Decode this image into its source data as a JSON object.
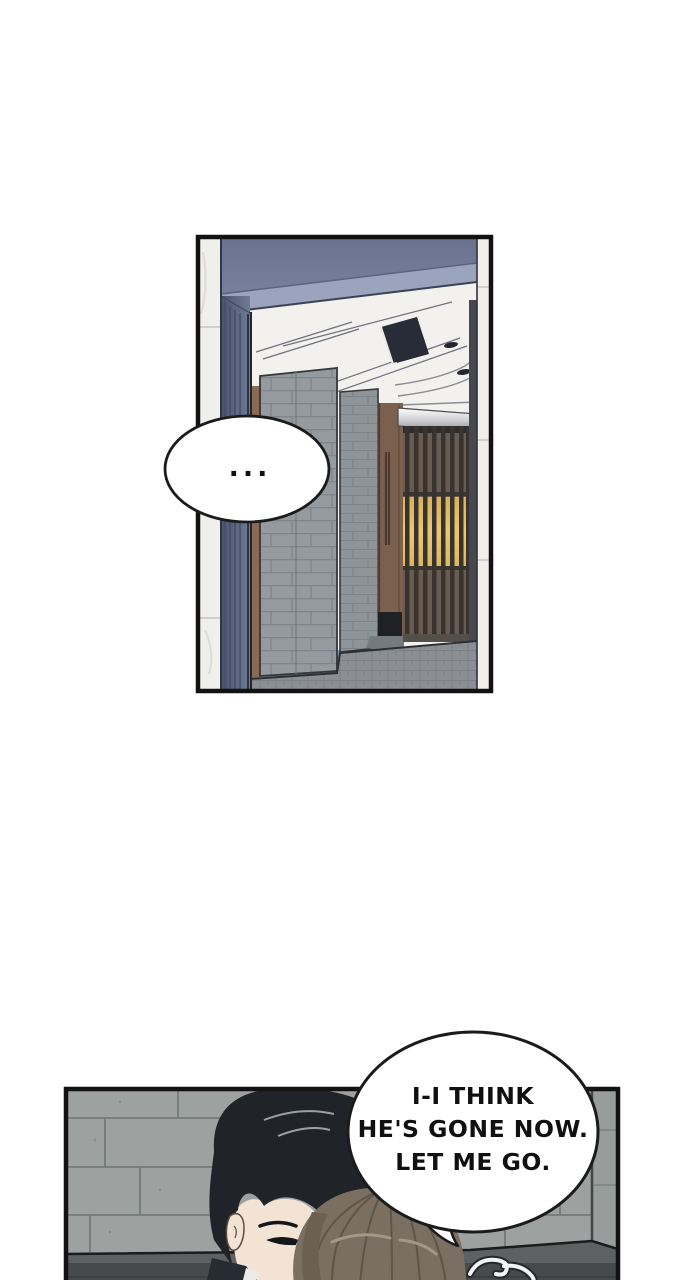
{
  "page": {
    "kind": "webtoon-comic-page"
  },
  "panel1": {
    "speech": {
      "text": "..."
    }
  },
  "panel2": {
    "speech": {
      "lines": [
        "I-I THINK",
        "HE'S GONE NOW.",
        "LET ME GO."
      ]
    }
  },
  "palette": {
    "page_bg": "#ffffff",
    "panel_border": "#121212",
    "wall_blue": "#7b86a3",
    "wall_blue_fascia": "#9aa4bd",
    "ceiling_white": "#f2f1ee",
    "marble": "#f0efec",
    "brick_gray": "#959a9f",
    "door_wood": "#7b604f",
    "screen_amber": "#e5be62",
    "slat_dark": "#37332f",
    "metal_header": "#cfd1d2",
    "floor_gray": "#8b8f94",
    "stone_wall": "#9da19f",
    "ledge_top": "#5d6162",
    "ledge_front": "#474a4b",
    "hair_black": "#202428",
    "hair_brown": "#7a6f60",
    "skin": "#f2e3d4",
    "bubble_fill": "#ffffff",
    "bubble_stroke": "#1b1b1b",
    "text_color": "#101010"
  }
}
